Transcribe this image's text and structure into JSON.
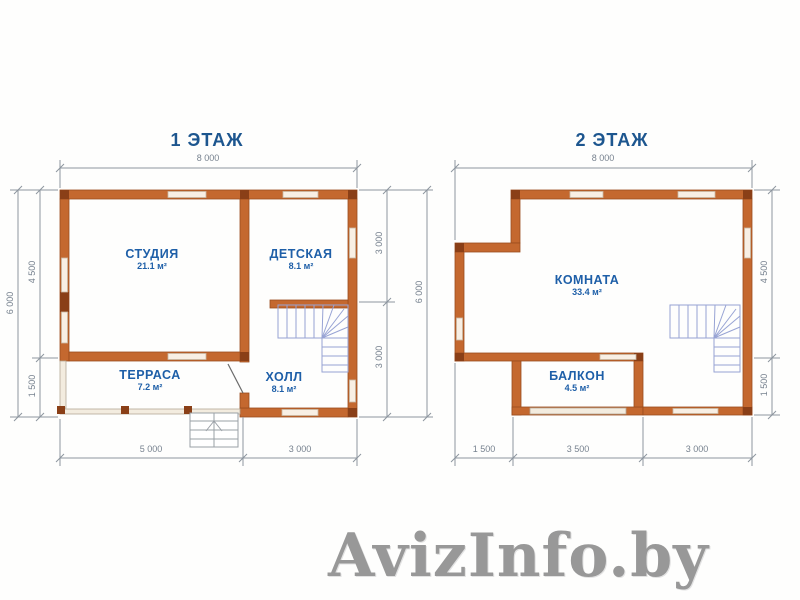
{
  "watermark": "AvizInfo.by",
  "palette": {
    "wall": "#c4682f",
    "wall_dark": "#8a3f17",
    "window": "#f8efe4",
    "railing": "#f3ecdf",
    "dimension_line": "#8d959e",
    "dimension_text": "#77828f",
    "label_text": "#1e5fa8",
    "stairs": "#97a3d4",
    "watermark_text": "#989898"
  },
  "plan1": {
    "title": "1 ЭТАЖ",
    "rooms": {
      "studio": {
        "name": "СТУДИЯ",
        "area": "21.1 м²"
      },
      "kids": {
        "name": "ДЕТСКАЯ",
        "area": "8.1 м²"
      },
      "terrace": {
        "name": "ТЕРРАСА",
        "area": "7.2 м²"
      },
      "hall": {
        "name": "ХОЛЛ",
        "area": "8.1 м²"
      }
    },
    "dims": {
      "top": "8 000",
      "left_outer": "6 000",
      "left_upper": "4 500",
      "left_lower": "1 500",
      "right_upper": "3 000",
      "right_lower": "3 000",
      "right_outer": "6 000",
      "bottom_left": "5 000",
      "bottom_right": "3 000"
    }
  },
  "plan2": {
    "title": "2 ЭТАЖ",
    "rooms": {
      "room": {
        "name": "КОМНАТА",
        "area": "33.4 м²"
      },
      "balcony": {
        "name": "БАЛКОН",
        "area": "4.5 м²"
      }
    },
    "dims": {
      "top": "8 000",
      "left_outer": "6 000",
      "right_upper": "4 500",
      "right_lower": "1 500",
      "bottom_left": "1 500",
      "bottom_mid": "3 500",
      "bottom_right": "3 000"
    }
  }
}
